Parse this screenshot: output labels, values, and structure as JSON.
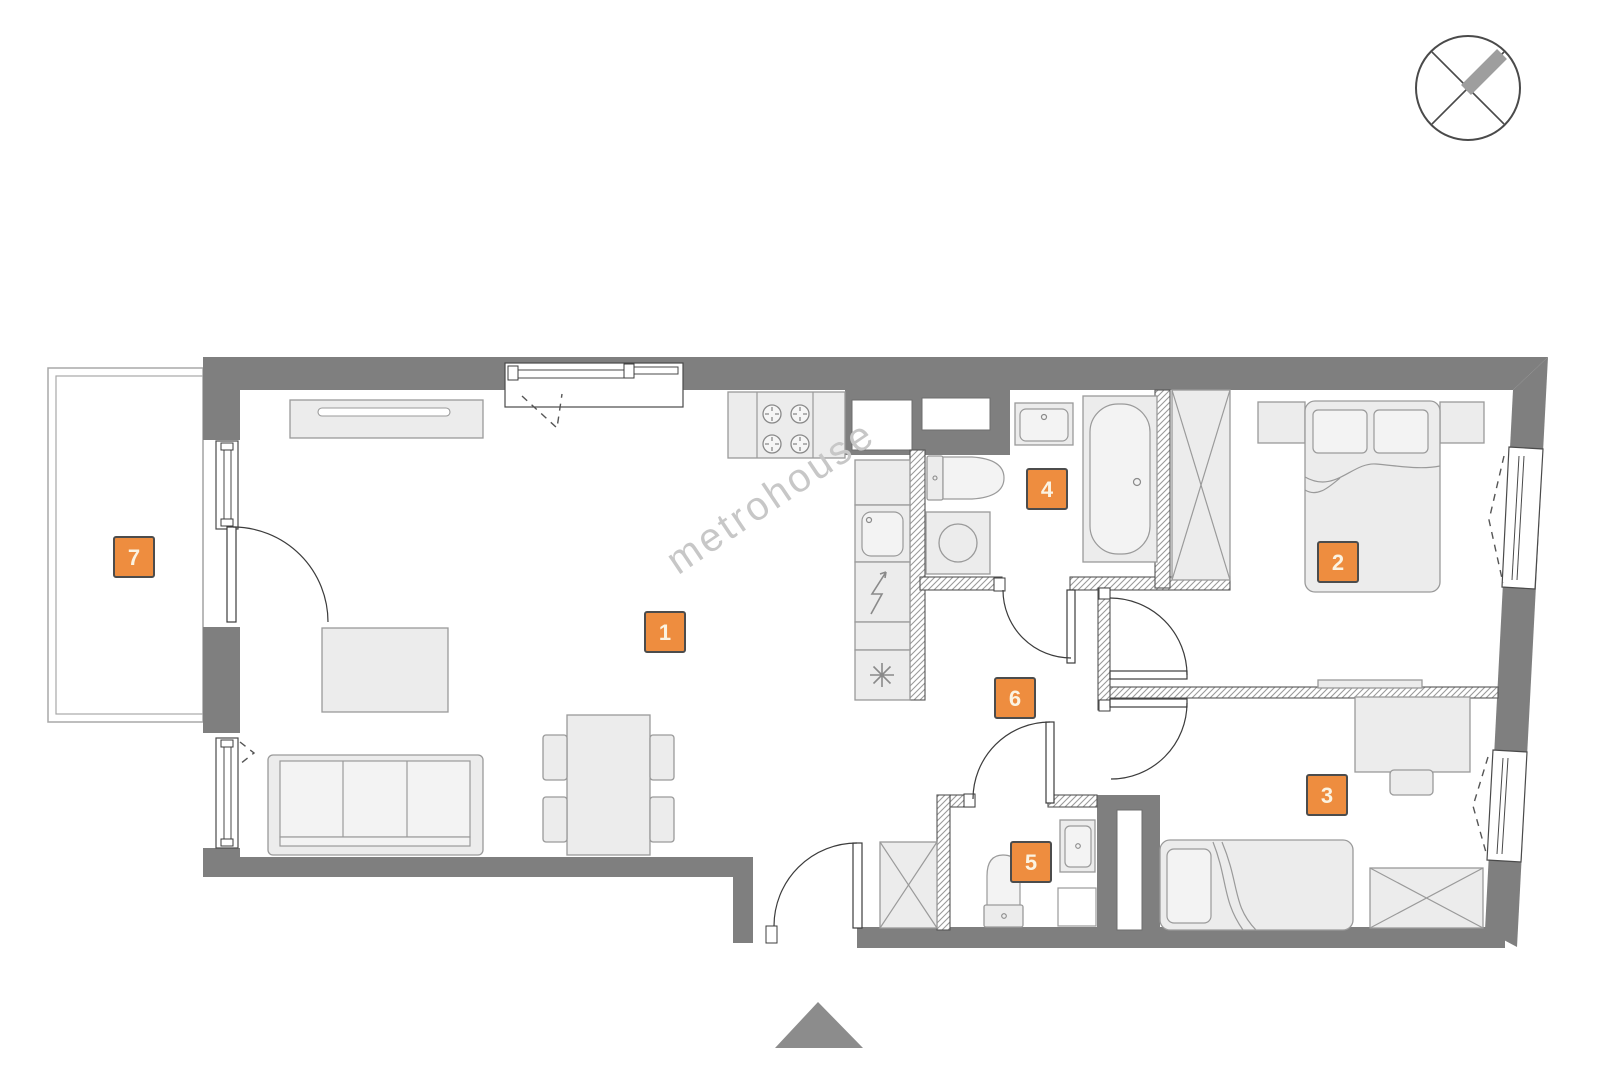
{
  "watermark": {
    "text": "metrohouse"
  },
  "rooms": [
    {
      "number": "1"
    },
    {
      "number": "2"
    },
    {
      "number": "3"
    },
    {
      "number": "4"
    },
    {
      "number": "5"
    },
    {
      "number": "6"
    },
    {
      "number": "7"
    }
  ],
  "colors": {
    "badge": "#ee8d3f",
    "badge_border": "#4c4c4c",
    "badge_text": "#fbf3e2",
    "wall": "#7f7f7f",
    "furniture_fill": "#ececec",
    "furniture_stroke": "#9a9a9a",
    "hatch_line": "#9a9a9a",
    "watermark": "#c7c7c7",
    "north_arrow": "#8c8c8c"
  }
}
